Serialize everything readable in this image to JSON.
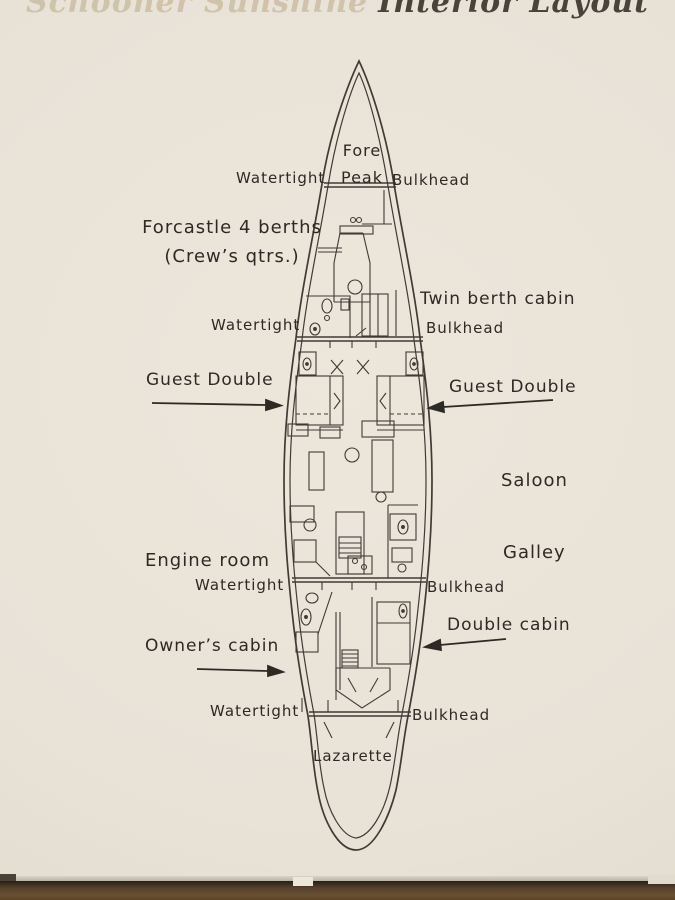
{
  "title": {
    "prefix": "Schooner Sunshine",
    "main": "Interior Layout"
  },
  "plan": {
    "fore_peak_line1": "Fore",
    "fore_peak_line2": "Peak",
    "watertight": "Watertight",
    "bulkhead": "Bulkhead",
    "forecastle_line1": "Forcastle 4 berths",
    "forecastle_line2": "(Crew’s qtrs.)",
    "twin_berth_cabin": "Twin berth cabin",
    "guest_double_left": "Guest Double",
    "guest_double_right": "Guest Double",
    "saloon": "Saloon",
    "galley": "Galley",
    "engine_room": "Engine room",
    "double_cabin": "Double cabin",
    "owners_cabin": "Owner’s cabin",
    "lazarette": "Lazarette"
  },
  "colors": {
    "paper": "#e8e2d7",
    "ink": "#3f3b35",
    "title_gold": "#bcaa87",
    "wood": "#6a4f33"
  }
}
